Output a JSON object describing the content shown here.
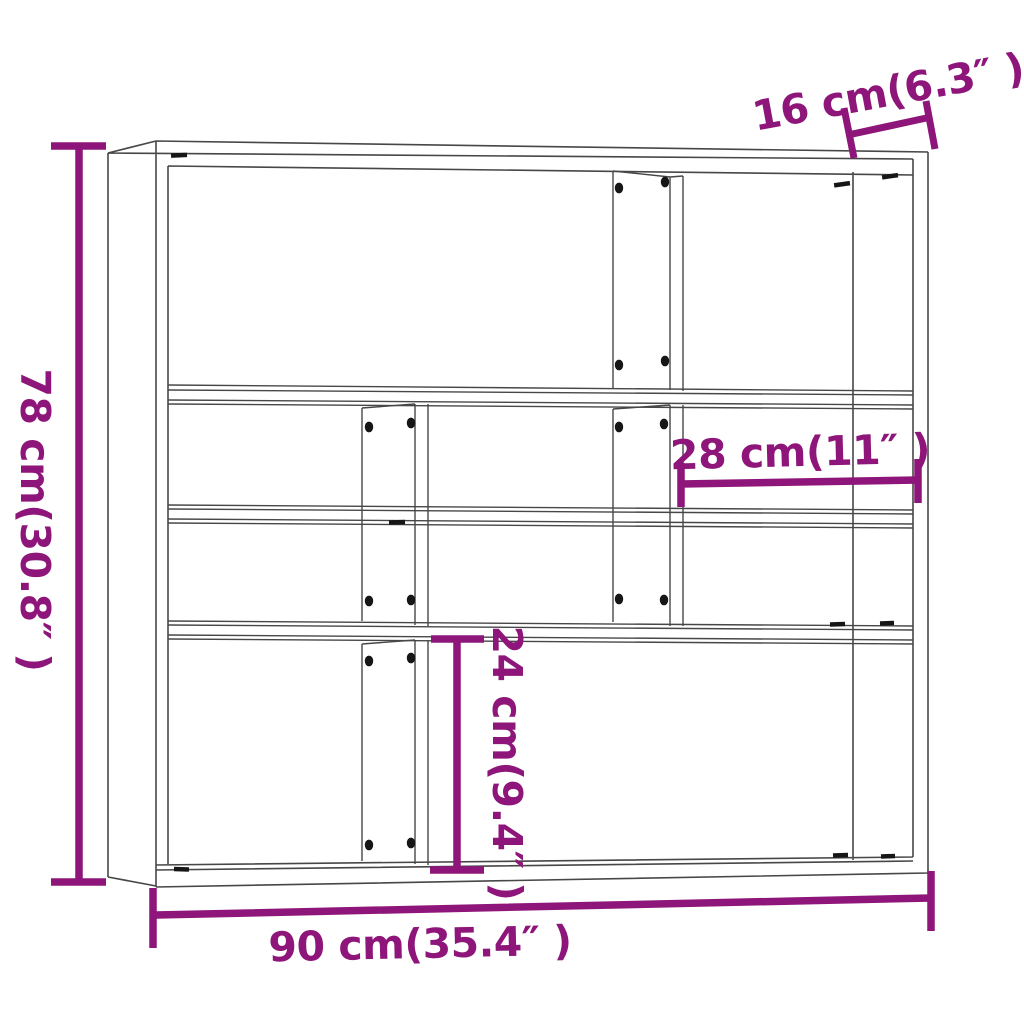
{
  "dimensions": {
    "height": "78 cm(30.8″ )",
    "depth": "16 cm(6.3″ )",
    "inner_width": "28 cm(11″ )",
    "inner_height": "24 cm(9.4″ )",
    "width": "90 cm(35.4″ )"
  },
  "colors": {
    "dimension": "#8E1579",
    "line": "#474747",
    "hardware": "#161616",
    "background": "#FFFFFF"
  }
}
